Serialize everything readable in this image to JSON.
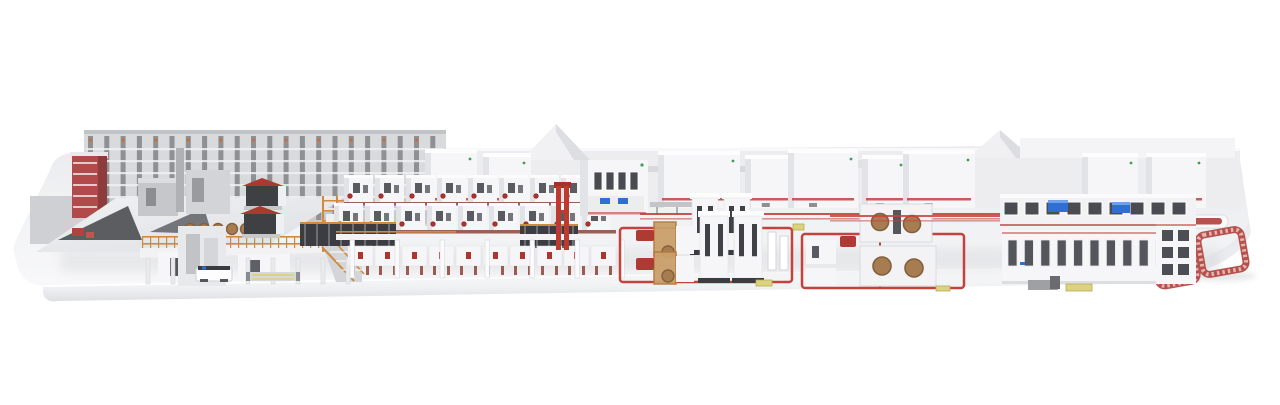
{
  "image": {
    "description": "3D rendering of a complete corrugated-board production plant displayed on a long white rounded platform, viewed from the front in slight perspective",
    "type": "3d-product-render",
    "background": "#ffffff"
  },
  "colors": {
    "platform_top": "#f1f2f4",
    "platform_front": "#fafafb",
    "platform_edge_shade": "#dcdde0",
    "machine_white": "#f6f6f8",
    "machine_side": "#e2e3e6",
    "machine_dark_panel": "#46474c",
    "backdrop_wall": "#ededef",
    "backdrop_shade": "#d8d9db",
    "rack_gray": "#8f9094",
    "accent_red": "#c0342e",
    "deep_red": "#a83a31",
    "conveyor_red": "#c4423c",
    "ring_red": "#b6524e",
    "ring_slat": "#e4b5b2",
    "orange_scaffold": "#cf8a3d",
    "roll_brown": "#a87c51",
    "roll_brown_dark": "#83603c",
    "screen_blue": "#2f6fd4",
    "logo_green": "#3f9e57",
    "pallet_yellow": "#ddd27e",
    "shadow": "#c9cacd"
  },
  "scene": {
    "platform": {
      "name": "display-platform"
    },
    "sections": [
      {
        "id": "roll-storage",
        "label": "high-bay roll storage",
        "columns": 22
      },
      {
        "id": "roll-handling",
        "label": "roll handling deck with AGV and pallet sled"
      },
      {
        "id": "wet-end",
        "label": "corrugator wet end with single facers",
        "paper_rolls": 5
      },
      {
        "id": "hood-machines",
        "label": "white hood machines along back wall",
        "count": 9
      },
      {
        "id": "dry-end",
        "label": "corrugator dry-end line",
        "modules_per_row": 9,
        "rows": 2,
        "floor_modules": 10,
        "support_columns": 7
      },
      {
        "id": "conveyor-loops",
        "label": "red floor conveyor loops",
        "loops": 2
      },
      {
        "id": "splicer-towers",
        "label": "twin splicer towers",
        "pairs": 2
      },
      {
        "id": "roll-splicers",
        "label": "roll stands with brown paper rolls",
        "rolls": 4
      },
      {
        "id": "converting-line",
        "label": "converting line with control screens",
        "door_panels": 11,
        "windows": 9,
        "screens": 2
      },
      {
        "id": "shuttle",
        "label": "white rail shuttle with red stripe"
      },
      {
        "id": "roller-rings",
        "label": "red roller conveyor rings",
        "rings": 2
      }
    ]
  }
}
